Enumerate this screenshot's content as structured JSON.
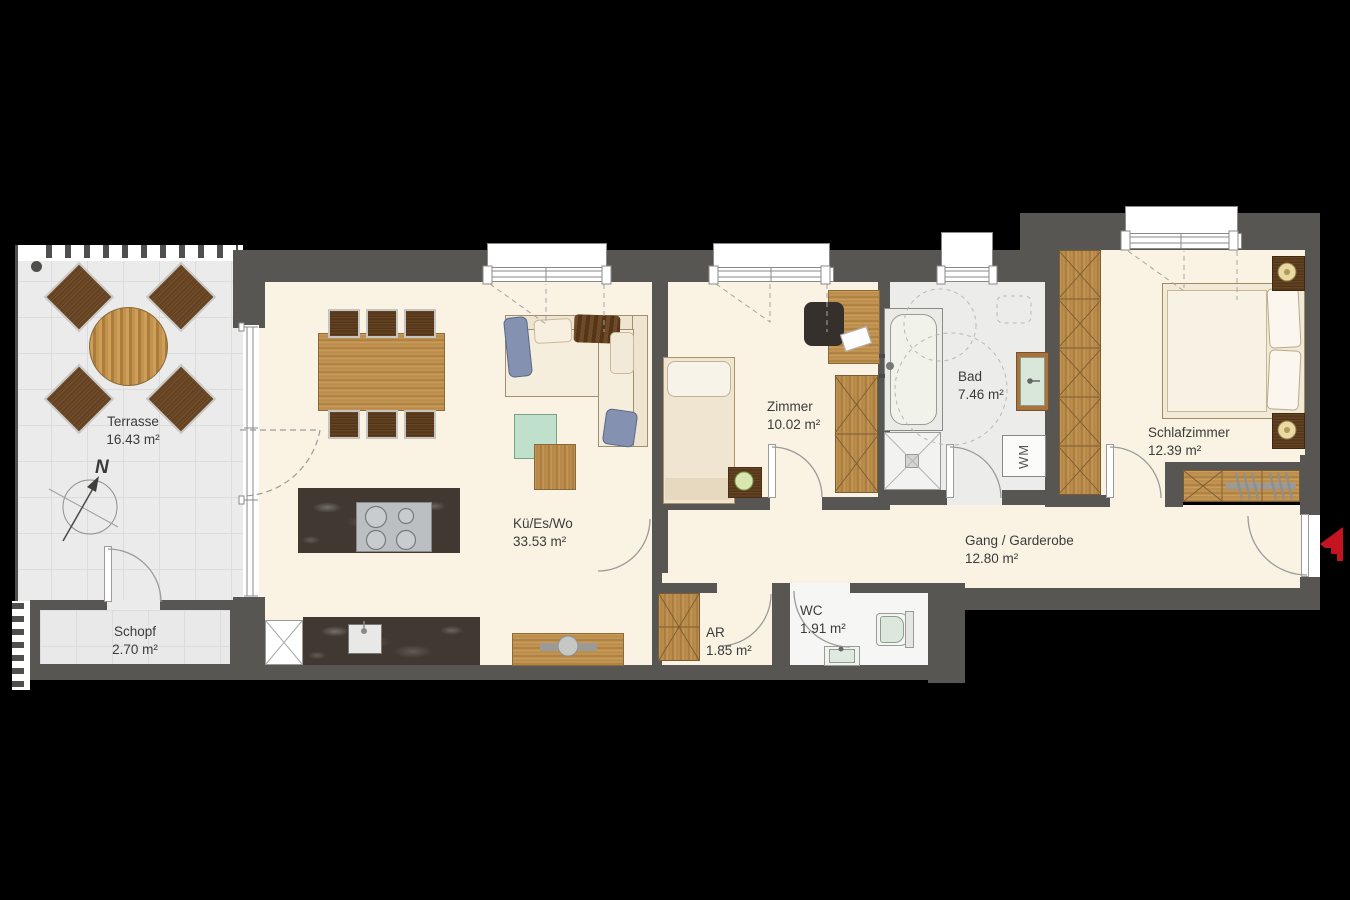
{
  "plan": {
    "title": "Apartment floor plan",
    "colors": {
      "background": "#000000",
      "wall": "#575653",
      "floor": "#faf3e3",
      "terrace_floor": "#ebebeb",
      "entry_arrow_red": "#c41420"
    },
    "rooms": [
      {
        "id": "terrasse",
        "name": "Terrasse",
        "area": "16.43 m²"
      },
      {
        "id": "schopf",
        "name": "Schopf",
        "area": "2.70 m²"
      },
      {
        "id": "kue-es-wo",
        "name": "Kü/Es/Wo",
        "area": "33.53 m²"
      },
      {
        "id": "zimmer",
        "name": "Zimmer",
        "area": "10.02 m²"
      },
      {
        "id": "bad",
        "name": "Bad",
        "area": "7.46 m²"
      },
      {
        "id": "ar",
        "name": "AR",
        "area": "1.85 m²"
      },
      {
        "id": "wc",
        "name": "WC",
        "area": "1.91 m²"
      },
      {
        "id": "gang",
        "name": "Gang / Garderobe",
        "area": "12.80 m²"
      },
      {
        "id": "schlafzimmer",
        "name": "Schlafzimmer",
        "area": "12.39 m²"
      }
    ],
    "annotations": {
      "compass_label": "N",
      "washing_machine_label": "WM"
    }
  }
}
